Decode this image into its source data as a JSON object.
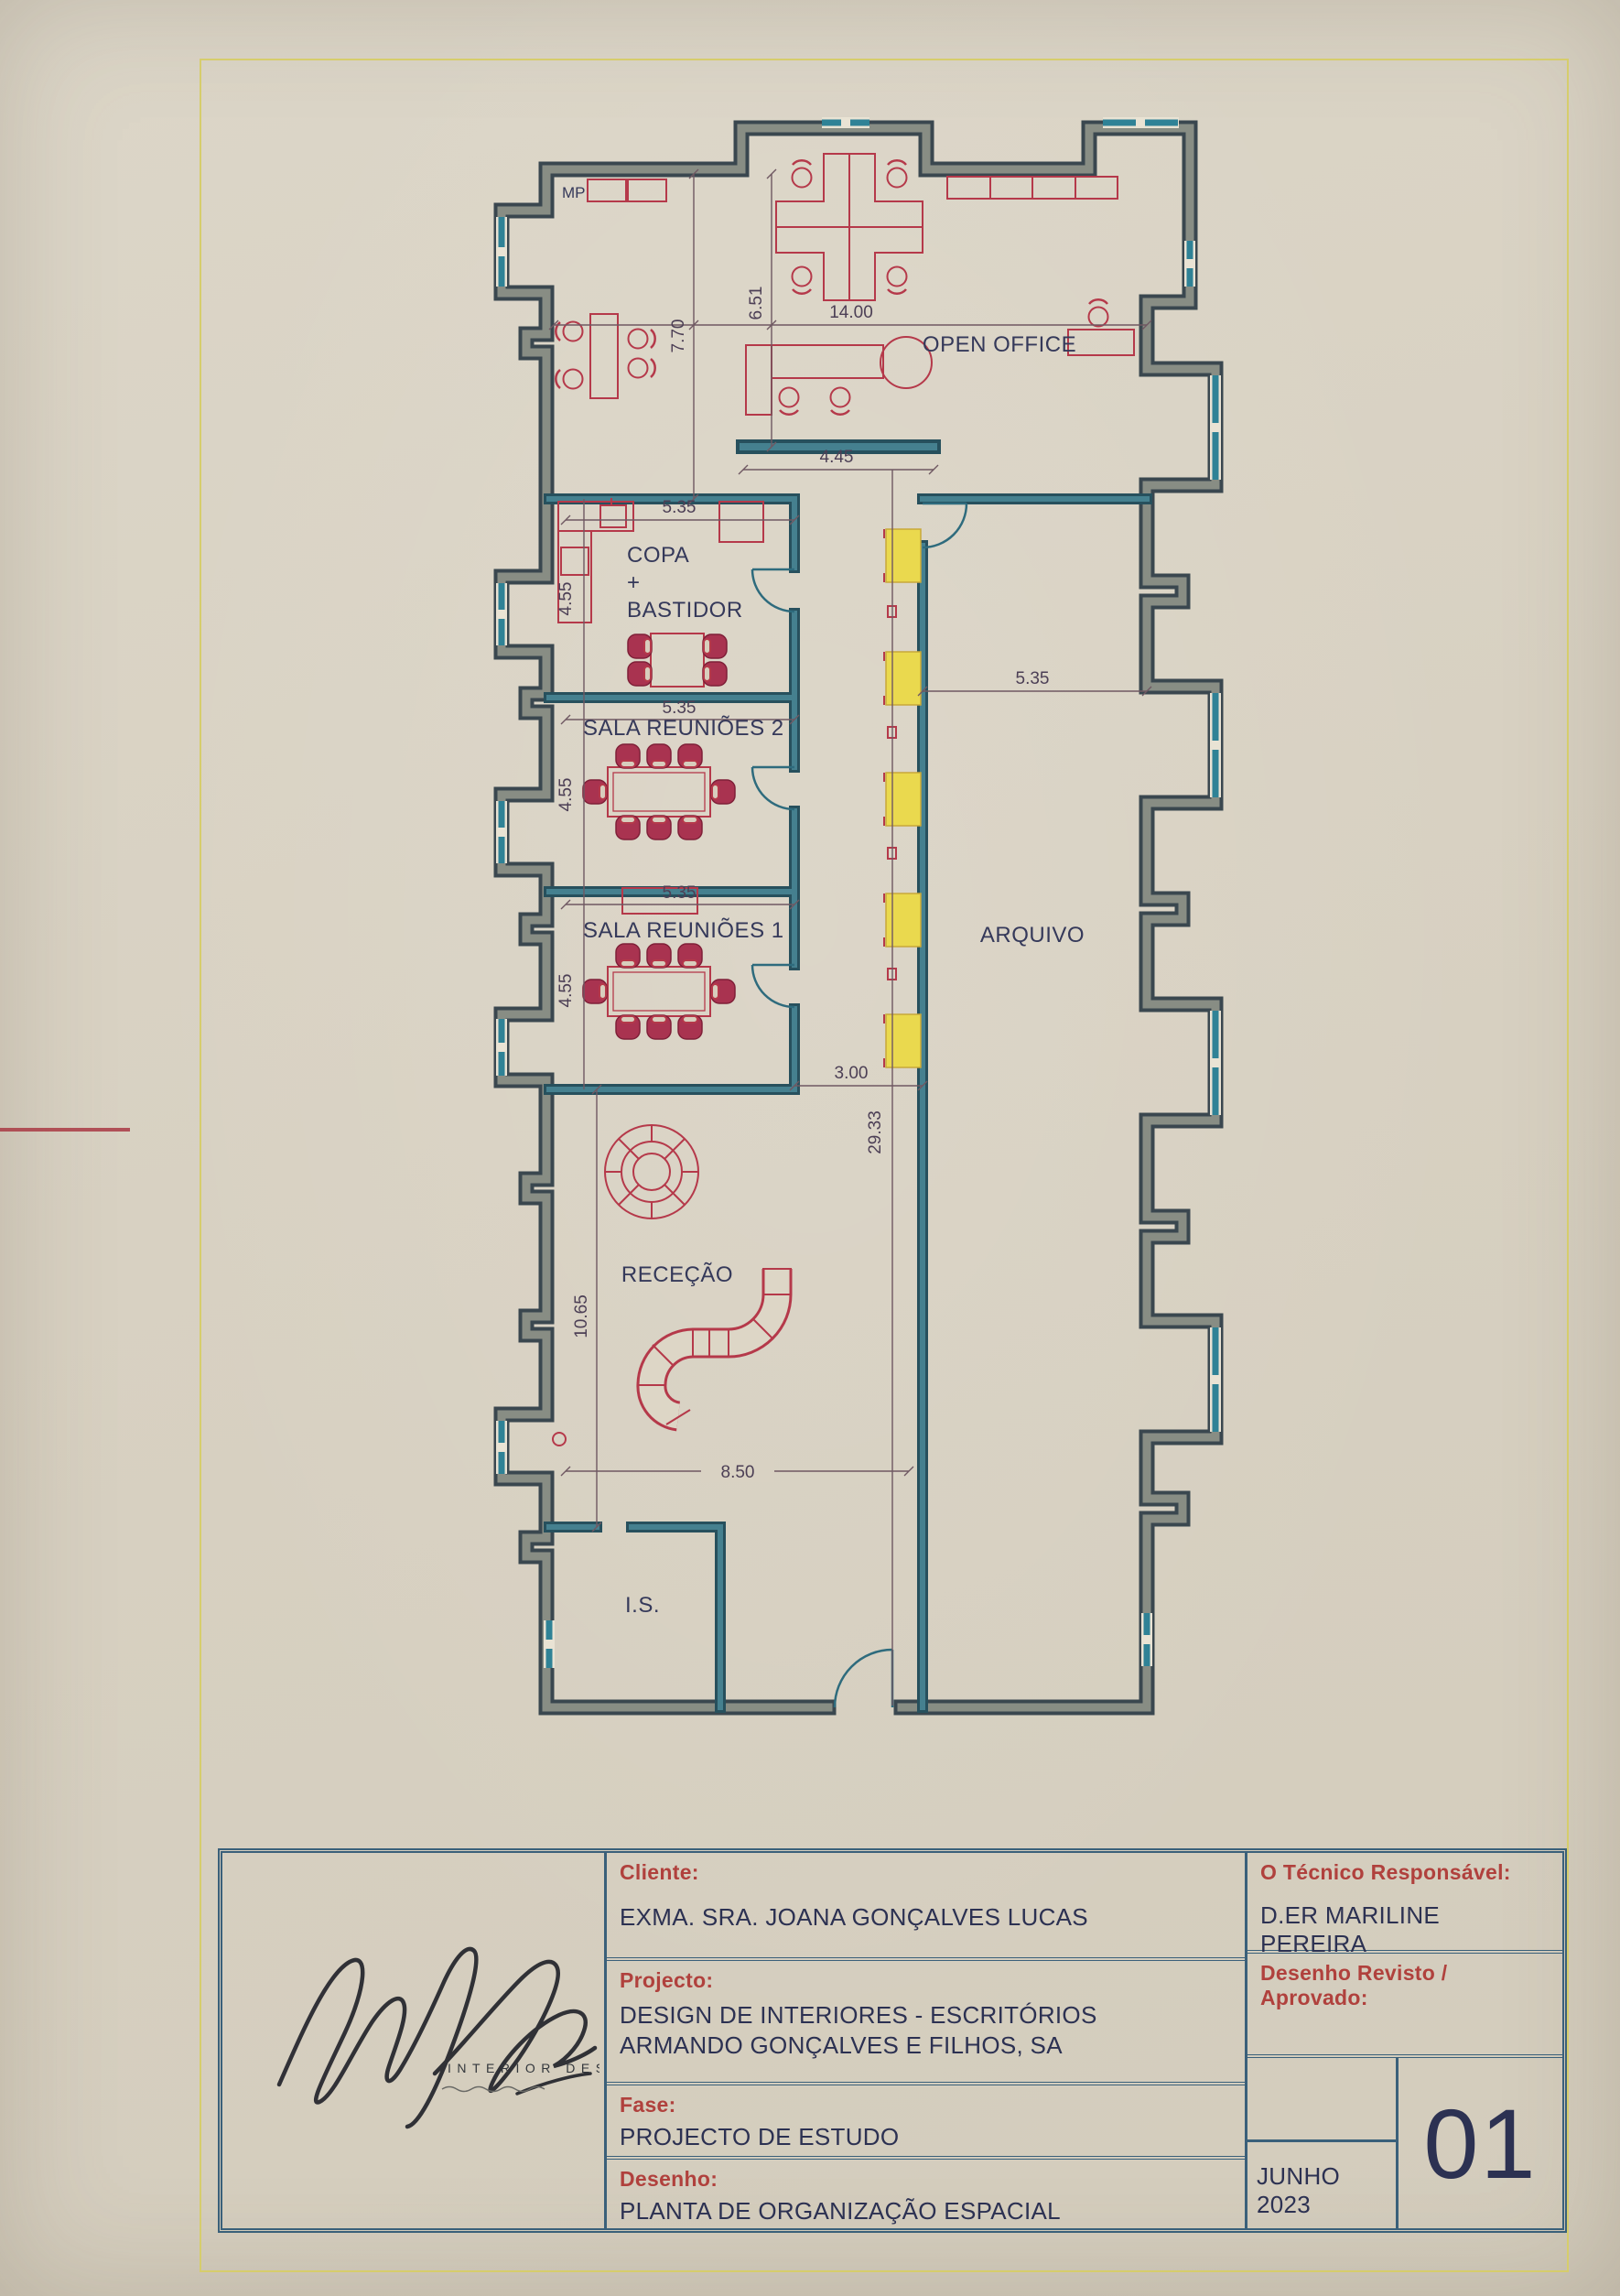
{
  "sheet": {
    "border_color": "#d6cd6c",
    "paper_color": "#d9d2c3"
  },
  "plan": {
    "rooms": {
      "open_office": "OPEN OFFICE",
      "copa_line1": "COPA",
      "copa_line2": "+",
      "copa_line3": "BASTIDOR",
      "sala_reunioes_2": "SALA REUNIÕES 2",
      "sala_reunioes_1": "SALA REUNIÕES 1",
      "arquivo": "ARQUIVO",
      "rececao": "RECEÇÃO",
      "is": "I.S.",
      "mp": "MP"
    },
    "dimensions": {
      "open_office_width": "14.00",
      "open_office_left_height": "7.70",
      "open_office_right_height": "6.51",
      "partition_length": "4.45",
      "copa_width": "5.35",
      "copa_height": "4.55",
      "sala2_width": "5.35",
      "sala2_height": "4.55",
      "sala1_width": "5.35",
      "sala1_height": "4.55",
      "arquivo_width": "5.35",
      "corridor_width": "3.00",
      "corridor_length": "29.33",
      "rececao_height": "10.65",
      "rececao_width": "8.50"
    }
  },
  "title_block": {
    "cliente_label": "Cliente:",
    "cliente_value": "EXMA. SRA. JOANA GONÇALVES LUCAS",
    "projecto_label": "Projecto:",
    "projecto_value": "DESIGN DE INTERIORES - ESCRITÓRIOS ARMANDO GONÇALVES E FILHOS, SA",
    "fase_label": "Fase:",
    "fase_value": "PROJECTO DE ESTUDO",
    "desenho_label": "Desenho:",
    "desenho_value": "PLANTA DE ORGANIZAÇÃO ESPACIAL",
    "tecnico_label": "O Técnico Responsável:",
    "tecnico_value": "D.ER MARILINE PEREIRA",
    "revisto_label": "Desenho Revisto / Aprovado:",
    "date": "JUNHO 2023",
    "sheet_number": "01",
    "logo_text": "INTERIOR DESIGN"
  }
}
